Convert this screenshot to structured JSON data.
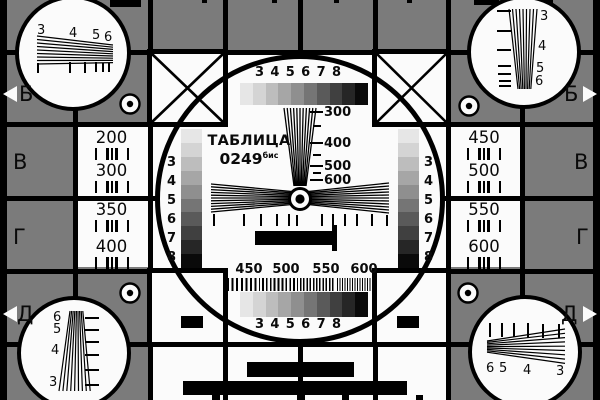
{
  "card_title": {
    "line1": "ТАБЛИЦА",
    "line2": "0249",
    "superscript": "бис"
  },
  "colors": {
    "background": "#7b7b7b",
    "panel_white": "#fbfbfb",
    "line_black": "#000000",
    "grayscale_steps": [
      "#e6e6e6",
      "#d4d4d4",
      "#bdbdbd",
      "#a6a6a6",
      "#8f8f8f",
      "#757575",
      "#5a5a5a",
      "#404040",
      "#262626",
      "#0a0a0a"
    ]
  },
  "center_circle": {
    "top_gray_scale_labels": [
      "3",
      "4",
      "5",
      "6",
      "7",
      "8"
    ],
    "bottom_gray_scale_labels": [
      "3",
      "4",
      "5",
      "6",
      "7",
      "8"
    ],
    "vertical_wedge_labels": [
      "300",
      "400",
      "500",
      "600"
    ],
    "burst_labels": [
      "450",
      "500",
      "550",
      "600"
    ],
    "left_strip_labels": [
      "3",
      "4",
      "5",
      "6",
      "7",
      "8"
    ],
    "right_strip_labels": [
      "3",
      "4",
      "5",
      "6",
      "7",
      "8"
    ]
  },
  "left_panel_values": [
    "200",
    "300",
    "350",
    "400"
  ],
  "right_panel_values": [
    "450",
    "500",
    "550",
    "600"
  ],
  "row_markers_left": [
    "Б",
    "В",
    "Г",
    "Д"
  ],
  "row_markers_right": [
    "Б",
    "В",
    "Г",
    "Д"
  ],
  "corner_wedge_labels": {
    "top_left": [
      "3",
      "4",
      "5",
      "6"
    ],
    "top_right": [
      "3",
      "4",
      "5",
      "6"
    ],
    "bottom_left": [
      "6",
      "5",
      "4",
      "3"
    ],
    "bottom_right": [
      "6",
      "5",
      "4",
      "3"
    ]
  }
}
